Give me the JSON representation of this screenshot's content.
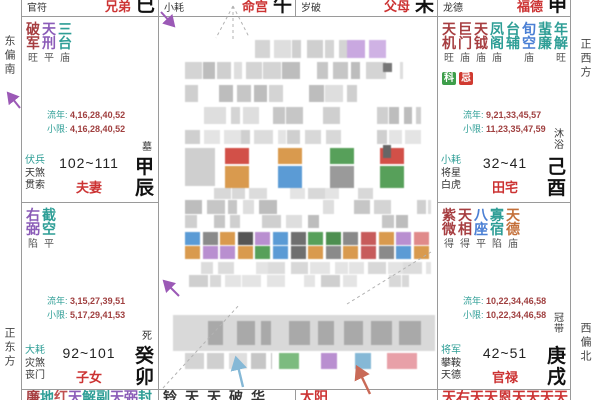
{
  "margins": {
    "top_left": "东偏南",
    "bottom_left": "正东方",
    "top_right": "正西方",
    "bottom_right": "西偏北"
  },
  "headers": [
    {
      "shen": "官符",
      "palace": "兄弟",
      "branch": "巳"
    },
    {
      "shen": "小耗",
      "palace": "命宫",
      "branch": "午"
    },
    {
      "shen": "岁破",
      "palace": "父母",
      "branch": "未"
    },
    {
      "shen": "龙德",
      "palace": "福德",
      "branch": "申"
    }
  ],
  "palaces": [
    {
      "id": "chen",
      "stars": [
        {
          "n": "破军",
          "c": "#a63d40",
          "s": "旺"
        },
        {
          "n": "天刑",
          "c": "#8b5cb8",
          "s": "平"
        },
        {
          "n": "三台",
          "c": "#2e9e96",
          "s": "庙"
        }
      ],
      "badges": [],
      "liunian": {
        "label": "流年:",
        "value": "4,16,28,40,52"
      },
      "xiaoxian": {
        "label": "小限:",
        "value": "4,16,28,40,52"
      },
      "shensha": [
        "伏兵",
        "天煞",
        "贯索"
      ],
      "age": "102~111",
      "changsheng": "墓",
      "ganzhi": "甲辰",
      "name": "夫妻"
    },
    {
      "id": "you",
      "stars": [
        {
          "n": "天机",
          "c": "#a63d40",
          "s": "旺"
        },
        {
          "n": "巨门",
          "c": "#a63d40",
          "s": "庙"
        },
        {
          "n": "天钺",
          "c": "#a63d40",
          "s": "庙"
        },
        {
          "n": "凤阁",
          "c": "#2e9e96",
          "s": "庙"
        },
        {
          "n": "台辅",
          "c": "#2e9e96",
          "s": ""
        },
        {
          "n": "旬空",
          "c": "#4a7fd4",
          "s": "庙"
        },
        {
          "n": "蜚廉",
          "c": "#2e9e96",
          "s": ""
        },
        {
          "n": "年解",
          "c": "#2e9e96",
          "s": "旺"
        }
      ],
      "badges": [
        {
          "t": "科",
          "bg": "#3d9e4a"
        },
        {
          "t": "忌",
          "bg": "#d03a30"
        }
      ],
      "liunian": {
        "label": "流年:",
        "value": "9,21,33,45,57"
      },
      "xiaoxian": {
        "label": "小限:",
        "value": "11,23,35,47,59"
      },
      "shensha": [
        "小耗",
        "将星",
        "白虎"
      ],
      "age": "32~41",
      "changsheng": "沐浴",
      "ganzhi": "己酉",
      "name": "田宅"
    },
    {
      "id": "mao",
      "stars": [
        {
          "n": "右弼",
          "c": "#8b5cb8",
          "s": "陷"
        },
        {
          "n": "截空",
          "c": "#2e9e96",
          "s": "平"
        }
      ],
      "badges": [],
      "liunian": {
        "label": "流年:",
        "value": "3,15,27,39,51"
      },
      "xiaoxian": {
        "label": "小限:",
        "value": "5,17,29,41,53"
      },
      "shensha": [
        "大耗",
        "灾煞",
        "丧门"
      ],
      "age": "92~101",
      "changsheng": "死",
      "ganzhi": "癸卯",
      "name": "子女"
    },
    {
      "id": "xu",
      "stars": [
        {
          "n": "紫微",
          "c": "#a63d40",
          "s": "得"
        },
        {
          "n": "天相",
          "c": "#a63d40",
          "s": "得"
        },
        {
          "n": "八座",
          "c": "#4a7fd4",
          "s": "平"
        },
        {
          "n": "寡宿",
          "c": "#2e9e96",
          "s": "陷"
        },
        {
          "n": "天德",
          "c": "#c4703a",
          "s": "庙"
        }
      ],
      "badges": [],
      "liunian": {
        "label": "流年:",
        "value": "10,22,34,46,58"
      },
      "xiaoxian": {
        "label": "小限:",
        "value": "10,22,34,46,58"
      },
      "shensha": [
        "将军",
        "攀鞍",
        "天德"
      ],
      "age": "42~51",
      "changsheng": "冠带",
      "ganzhi": "庚戌",
      "name": "官禄"
    }
  ],
  "bottom_row": [
    {
      "chars": [
        {
          "t": "廉",
          "c": "#a63d40"
        },
        {
          "t": "地",
          "c": "#2e9e96"
        },
        {
          "t": "红",
          "c": "#c05050"
        },
        {
          "t": "天",
          "c": "#8b5cb8"
        },
        {
          "t": "解",
          "c": "#2e9e96"
        },
        {
          "t": "副",
          "c": "#2e9e96"
        },
        {
          "t": "天",
          "c": "#8b5cb8"
        },
        {
          "t": "弼",
          "c": "#8b5cb8"
        },
        {
          "t": "封",
          "c": "#2e9e96"
        }
      ]
    },
    {
      "chars": [
        {
          "t": "铃",
          "c": "#333333"
        },
        {
          "t": "天",
          "c": "#333333"
        },
        {
          "t": "天",
          "c": "#333333"
        },
        {
          "t": "破",
          "c": "#333333"
        },
        {
          "t": "华",
          "c": "#333333"
        }
      ]
    },
    {
      "chars": [
        {
          "t": "太",
          "c": "#cc3333"
        },
        {
          "t": "阳",
          "c": "#cc3333"
        }
      ]
    },
    {
      "chars": [
        {
          "t": "天",
          "c": "#cc3333"
        },
        {
          "t": "右",
          "c": "#cc3333"
        },
        {
          "t": "天",
          "c": "#cc3333"
        },
        {
          "t": "天",
          "c": "#cc3333"
        },
        {
          "t": "恩",
          "c": "#cc3333"
        },
        {
          "t": "天",
          "c": "#cc3333"
        },
        {
          "t": "天",
          "c": "#cc3333"
        },
        {
          "t": "天",
          "c": "#cc3333"
        },
        {
          "t": "天",
          "c": "#cc3333"
        }
      ]
    }
  ],
  "colors": {
    "accent_red": "#cc3333",
    "star_red": "#a63d40",
    "star_teal": "#2e9e96",
    "star_purple": "#8b5cb8",
    "arrow_purple": "#9b59b6",
    "arrow_blue": "#85b8d6",
    "arrow_red": "#c96a57"
  }
}
